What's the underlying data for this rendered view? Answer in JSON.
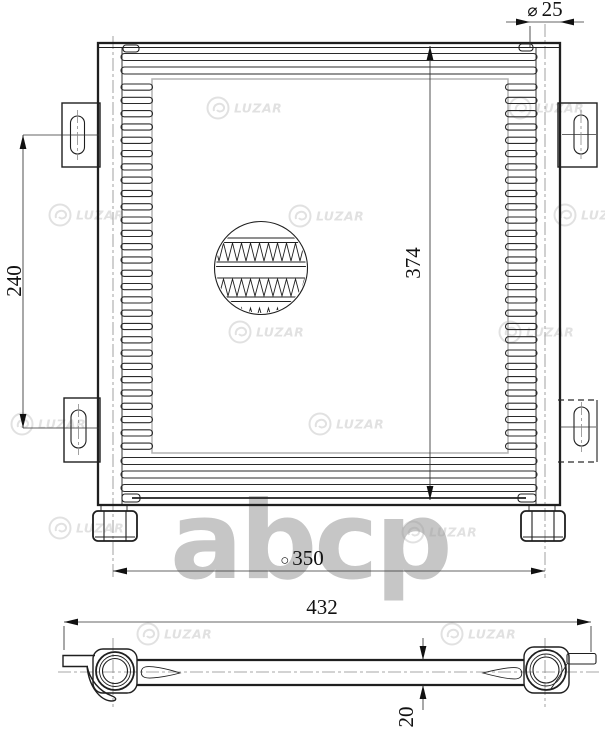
{
  "dimensions": {
    "pipe_diameter": {
      "symbol": "⌀",
      "value": "25"
    },
    "mount_spacing": {
      "value": "240"
    },
    "core_height": {
      "value": "374"
    },
    "port_centers": {
      "symbol": "○",
      "value": "350"
    },
    "overall_width": {
      "value": "432"
    },
    "core_depth": {
      "value": "20"
    }
  },
  "watermark": {
    "brand": "LUZAR",
    "letters": "abcp"
  }
}
